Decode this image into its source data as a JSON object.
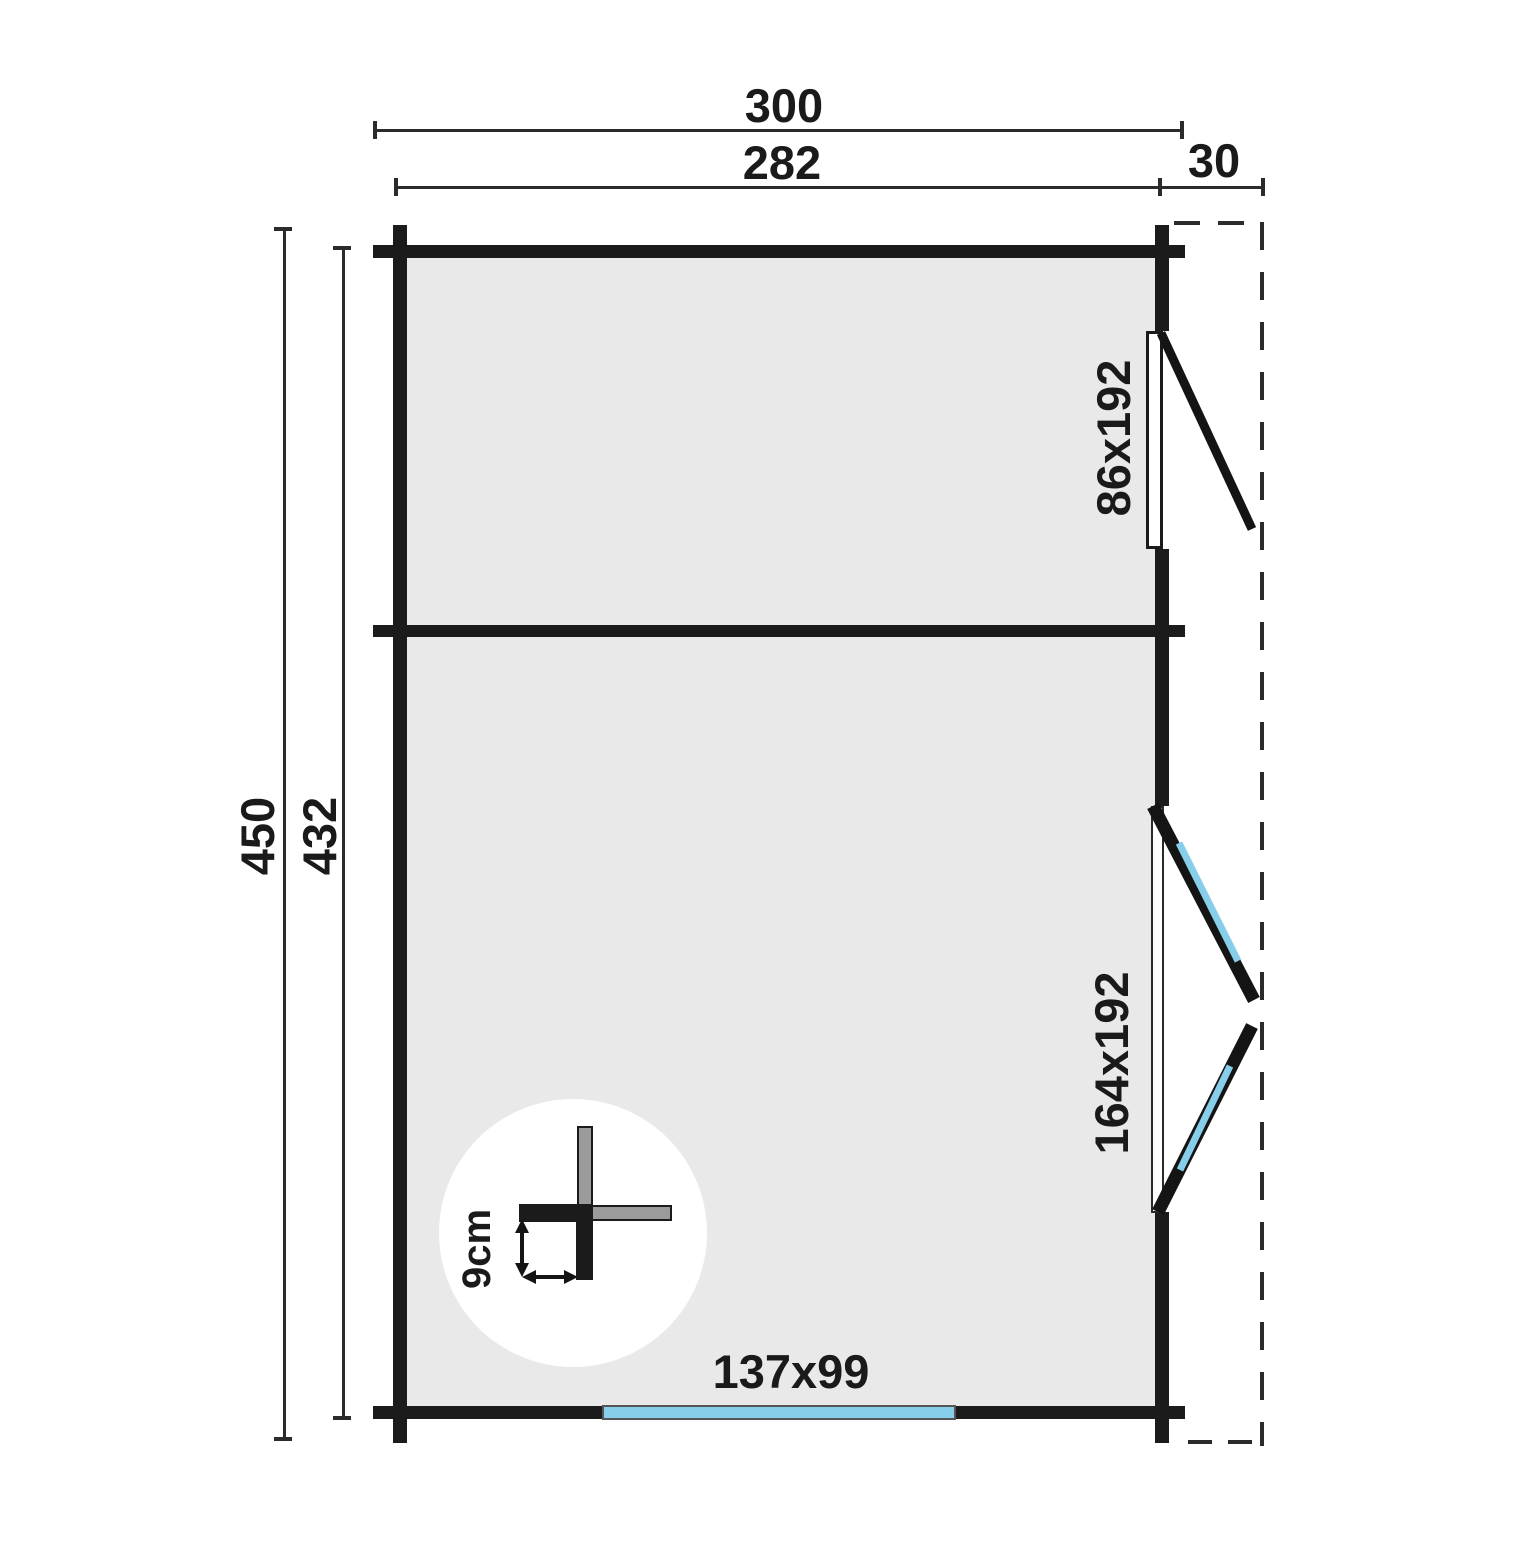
{
  "diagram": {
    "type": "floor-plan",
    "dimensions": {
      "width_total": "300",
      "width_inner": "282",
      "side_overhang": "30",
      "depth_total": "450",
      "depth_inner": "432"
    },
    "openings": {
      "side_window": "86x192",
      "side_double_door": "164x192",
      "front_window": "137x99"
    },
    "detail": {
      "wall_thickness": "9cm"
    },
    "colors": {
      "wall": "#1b1b1b",
      "floor": "#e9e9e9",
      "glazing": "#87ceeb",
      "dimension_line": "#2b2b2b"
    }
  }
}
